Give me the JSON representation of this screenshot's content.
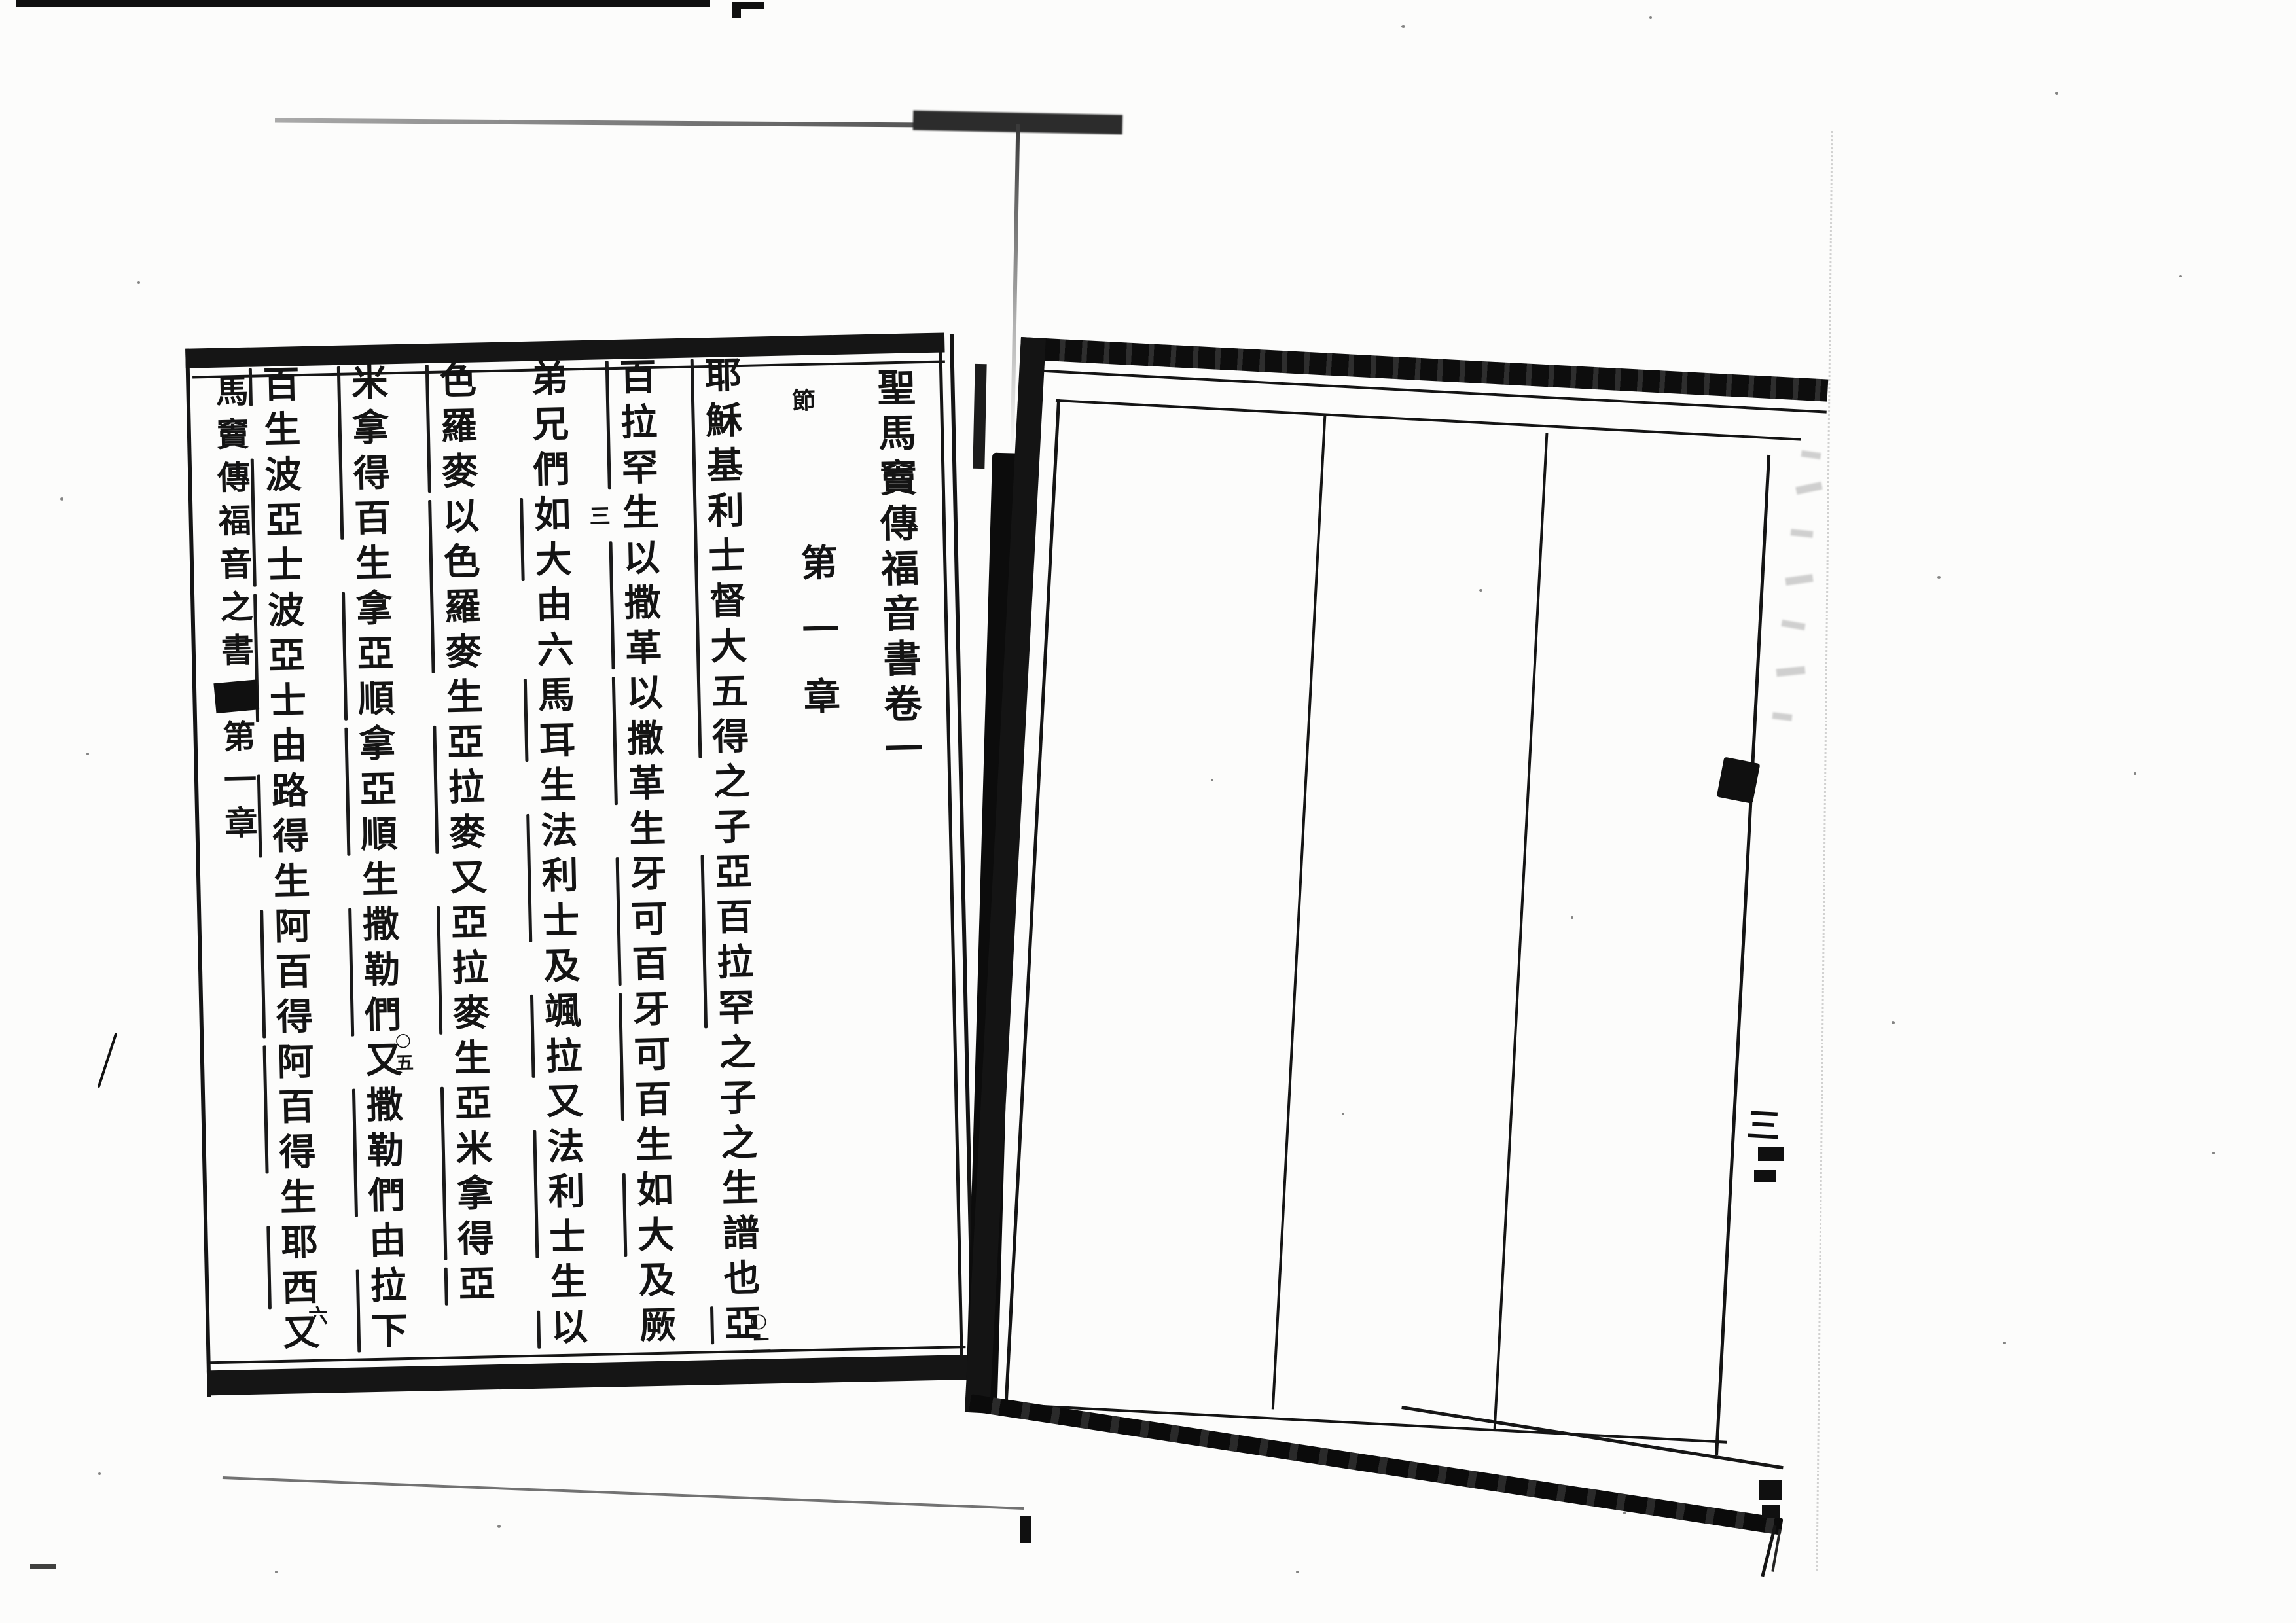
{
  "book": {
    "title": "聖馬竇傳福音書卷一"
  },
  "left_page": {
    "title_column": "聖馬竇傳福音書卷一",
    "verse_section_mark": "節",
    "chapter_heading": "第一章",
    "body_columns": [
      "耶穌基利士督大五得之子亞百拉罕之子之生譜也亞",
      "百拉罕生以撒革以撒革生牙可百牙可百生如大及厥",
      "弟兄們如大由六馬耳生法利士及颯拉又法利士生以",
      "色羅麥以色羅麥生亞拉麥又亞拉麥生亞米拿得亞",
      "米拿得百生拿亞順拿亞順生撒勒們又撒勒們由拉下",
      "百生波亞士波亞士由路得生阿百得阿百得生耶西又"
    ],
    "verse_markers": [
      {
        "label": "○二",
        "position": "column-1-bottom"
      },
      {
        "label": "三",
        "position": "column-3-top"
      },
      {
        "label": "○五",
        "position": "column-5-middle"
      },
      {
        "label": "六",
        "position": "column-6-bottom"
      }
    ],
    "fold_column": {
      "running_title": "馬竇傳福音之書",
      "chapter": "第一章"
    }
  },
  "right_page": {
    "page_number": "三",
    "content": ""
  }
}
